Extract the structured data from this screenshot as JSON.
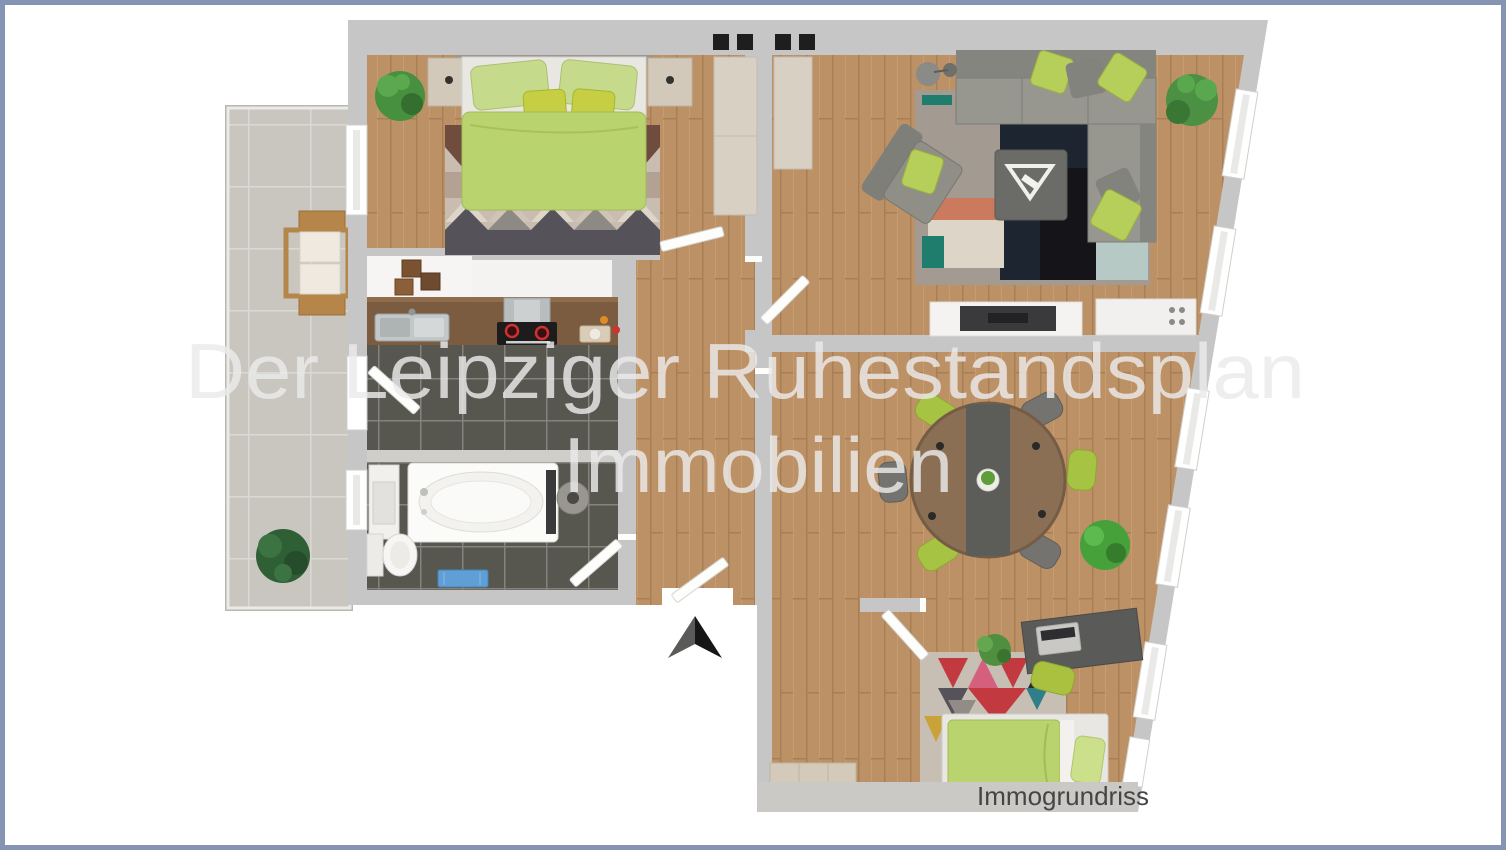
{
  "watermark": {
    "line1": "Der Leipziger Ruhestandsplan",
    "line2": "Immobilien"
  },
  "footer": {
    "label": "Immogrundriss"
  },
  "colors": {
    "frame": "#8494b2",
    "wall": "#c6c6c6",
    "wall_light": "#d2d1cf",
    "watermark": "#ebebeb",
    "label_text": "#454545",
    "accent_green": "#b9d36e",
    "pillow_green": "#b5cf5a",
    "wood": "#bd9166",
    "tile_dark": "#57564f",
    "balcony_tile": "#c9c6bf",
    "sofa_gray": "#90908a",
    "table_wood": "#8b6f55",
    "arrow_dark": "#161616",
    "arrow_mid": "#5a5a58"
  }
}
